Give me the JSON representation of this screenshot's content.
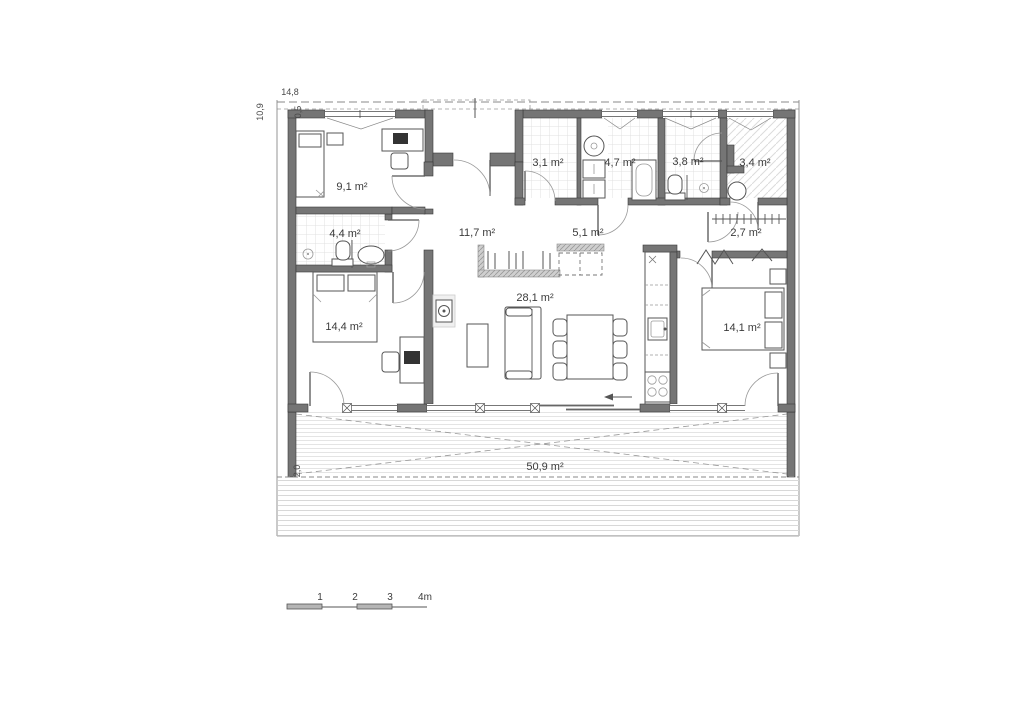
{
  "plan": {
    "type": "floor-plan",
    "rooms": [
      {
        "id": "bedroom-small",
        "label": "9,1 m²"
      },
      {
        "id": "bathroom-entry",
        "label": "3,1 m²"
      },
      {
        "id": "bathroom-main",
        "label": "4,7 m²"
      },
      {
        "id": "wc",
        "label": "3,8 m²"
      },
      {
        "id": "utility-room",
        "label": "3,4 m²"
      },
      {
        "id": "ensuite-bathroom",
        "label": "4,4 m²"
      },
      {
        "id": "hallway",
        "label": "11,7 m²"
      },
      {
        "id": "closet",
        "label": "5,1 m²"
      },
      {
        "id": "wardrobe",
        "label": "2,7 m²"
      },
      {
        "id": "bedroom-left",
        "label": "14,4 m²"
      },
      {
        "id": "living-room",
        "label": "28,1 m²"
      },
      {
        "id": "bedroom-right",
        "label": "14,1 m²"
      },
      {
        "id": "terrace",
        "label": "50,9 m²"
      }
    ],
    "dimensions": {
      "overall_width": "14,8",
      "overall_depth": "10,9",
      "roof_overhang": "0,5",
      "terrace_depth": "2,0"
    },
    "scale_bar": {
      "ticks": [
        "1",
        "2",
        "3",
        "4m"
      ]
    }
  }
}
